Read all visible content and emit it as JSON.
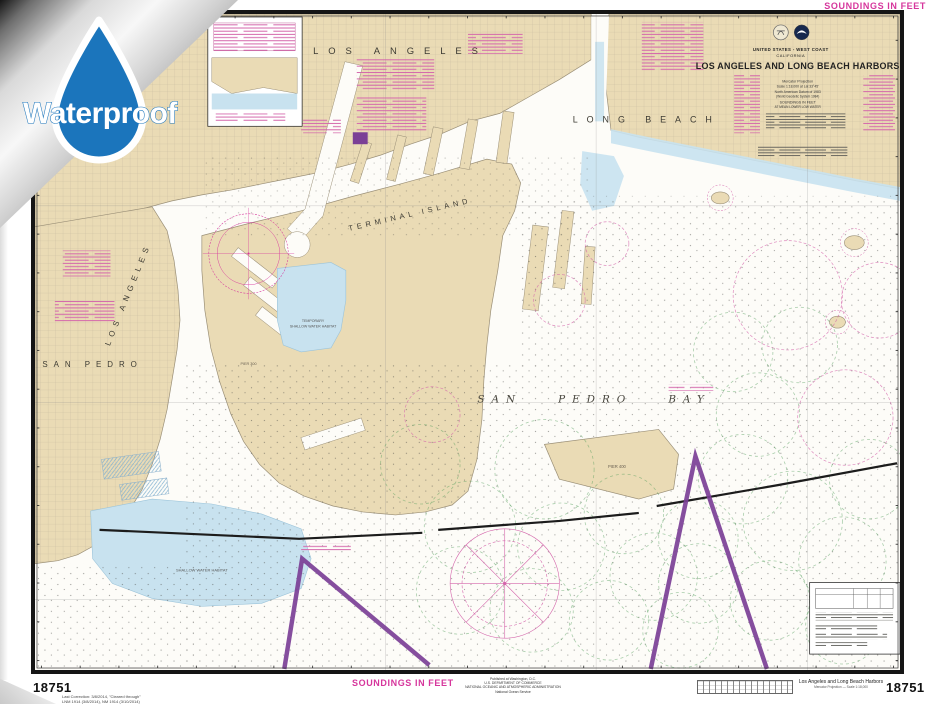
{
  "badge": {
    "label": "Waterproof"
  },
  "header": {
    "soundings_note_top": "SOUNDINGS IN FEET"
  },
  "title_block": {
    "agency_line": "UNITED STATES - WEST COAST",
    "state": "CALIFORNIA",
    "title": "LOS ANGELES AND LONG BEACH HARBORS",
    "projection": "Mercator Projection",
    "scale": "Scale 1:18,000 at Lat 33°45'",
    "datum": "North American Datum of 1983",
    "datum_note": "(World Geodetic System 1984)",
    "soundings_line1": "SOUNDINGS IN FEET",
    "soundings_line2": "AT MEAN LOWER LOW WATER"
  },
  "map_labels": {
    "city_top": "LOS ANGELES",
    "long_beach": "LONG BEACH",
    "terminal_island": "TERMINAL ISLAND",
    "san_pedro": "SAN PEDRO",
    "city_side": "LOS ANGELES",
    "bay": "SAN PEDRO BAY",
    "habitat_line1": "TEMPORARY",
    "habitat_line2": "SHALLOW WATER HABITAT",
    "habitat_sw": "SHALLOW WATER HABITAT",
    "pier_300": "PIER 300",
    "pier_400": "PIER 400"
  },
  "footer": {
    "soundings_note_bottom": "SOUNDINGS IN FEET",
    "chart_number_left": "18751",
    "chart_number_right": "18751",
    "correction_line1": "Last Correction: 3/8/2014, \"Cleared through\"",
    "correction_line2": "LNM 1914 (3/8/2014), NM 1914 (3/10/2014)",
    "publisher_line1": "Published at Washington, D.C.",
    "publisher_line2": "U.S. DEPARTMENT OF COMMERCE",
    "publisher_line3": "NATIONAL OCEANIC AND ATMOSPHERIC ADMINISTRATION",
    "publisher_line4": "National Ocean Service",
    "small_title": "Los Angeles and Long Beach Harbors",
    "small_title_sub": "Mercator Projection — Scale 1:18,000"
  },
  "colors": {
    "land": "#EADBB5",
    "shallow_water": "#C8E2EF",
    "magenta": "#D6369C",
    "traffic_lane_purple": "#7B3F96",
    "anchorage_green": "#55A05E",
    "badge_blue": "#1B75BC"
  }
}
